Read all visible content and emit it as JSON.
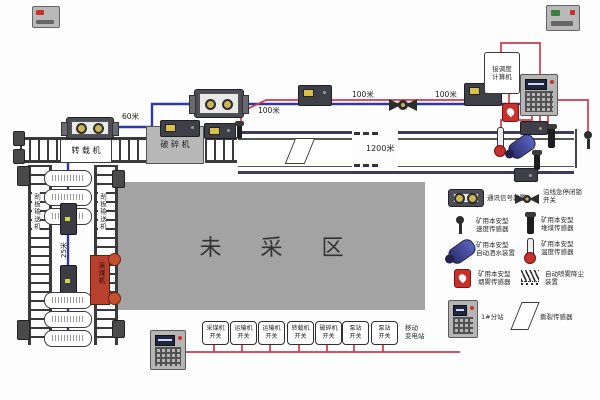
{
  "colors": {
    "cable_blue": "#2f3a9e",
    "wire_red": "#cf3a4e",
    "area_gray": "#a3a3a3",
    "panel_gray": "#b5b5b5",
    "alarm_red": "#c9302c"
  },
  "labels": {
    "transfer_machine": "转 载 机",
    "crusher": "破 碎 机",
    "unmined_area": "未 采 区",
    "shearer": "采煤机",
    "left_conveyor": "刮板输送机",
    "right_conveyor": "刮板输送机",
    "dist_60": "60米",
    "dist_100_a": "100米",
    "dist_100_b": "100米",
    "dist_100_c": "100米",
    "dist_1200": "1200米",
    "dist_25": "25米",
    "dispatch_box_line1": "接调度",
    "dispatch_box_line2": "计算机",
    "transformer_line1": "移动",
    "transformer_line2": "变电站"
  },
  "switch_boxes": [
    {
      "line1": "采煤机",
      "line2": "开关"
    },
    {
      "line1": "运输机",
      "line2": "开关"
    },
    {
      "line1": "运输机",
      "line2": "开关"
    },
    {
      "line1": "转载机",
      "line2": "开关"
    },
    {
      "line1": "破碎机",
      "line2": "开关"
    },
    {
      "line1": "泵站",
      "line2": "开关"
    },
    {
      "line1": "泵站",
      "line2": "开关"
    }
  ],
  "legend": {
    "items": [
      {
        "icon": "signal-device-icon",
        "line1": "通讯信号装置",
        "line2": ""
      },
      {
        "icon": "emergency-stop-switch-icon",
        "line1": "沿线急停闭锁",
        "line2": "开关"
      },
      {
        "icon": "speed-sensor-icon",
        "line1": "矿用本安型",
        "line2": "速度传感器"
      },
      {
        "icon": "coal-pile-sensor-icon",
        "line1": "矿用本安型",
        "line2": "堆煤传感器"
      },
      {
        "icon": "water-spray-icon",
        "line1": "矿用本安型",
        "line2": "自动洒水装置"
      },
      {
        "icon": "temperature-sensor-icon",
        "line1": "矿用本安型",
        "line2": "温度传感器"
      },
      {
        "icon": "smoke-sensor-icon",
        "line1": "矿用本安型",
        "line2": "烟雾传感器"
      },
      {
        "icon": "spray-dedust-icon",
        "line1": "自动喷雾降尘",
        "line2": "装置"
      },
      {
        "icon": "substation-icon",
        "line1": "1#分站",
        "line2": ""
      },
      {
        "icon": "tear-sensor-icon",
        "line1": "撕裂传感器",
        "line2": ""
      }
    ]
  }
}
